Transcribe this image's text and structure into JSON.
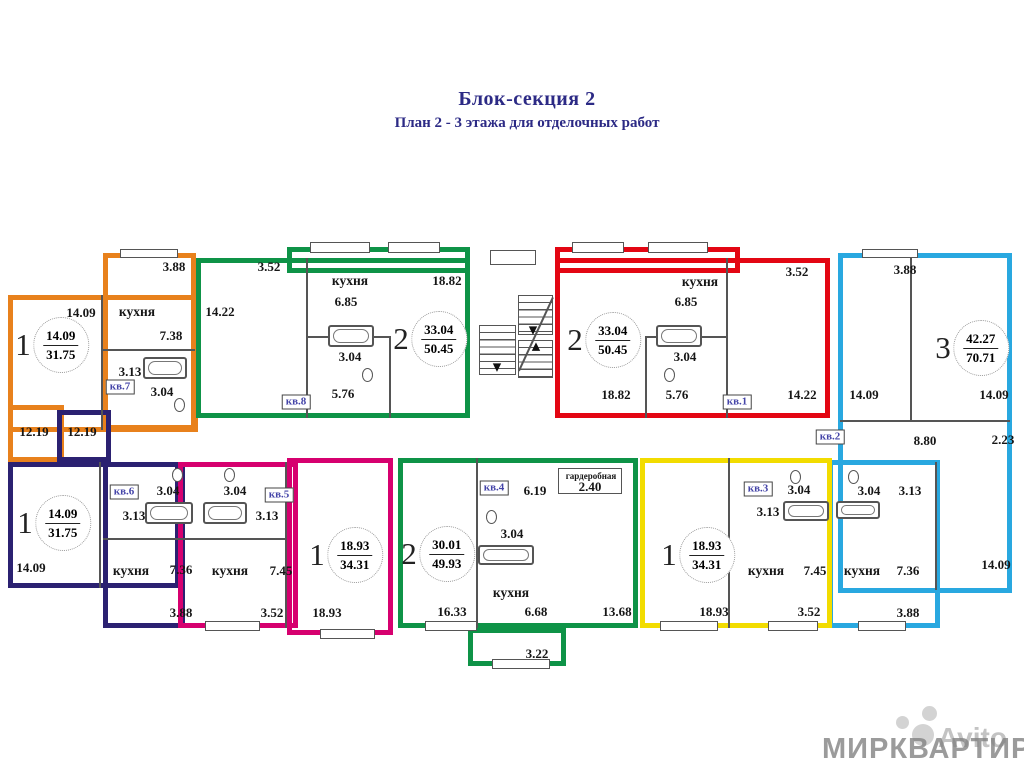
{
  "title": "Блок-секция 2",
  "subtitle": "План 2 - 3 этажа для отделочных работ",
  "watermarks": {
    "primary": "МИРКВАРТИР",
    "secondary": "Avito"
  },
  "colors": {
    "orange": "#E8811C",
    "green": "#0E9347",
    "red": "#E30613",
    "cyan": "#29A8E0",
    "navy": "#2B2171",
    "magenta": "#D6006F",
    "yellow": "#F2DC00",
    "title_text": "#2C2A85",
    "unit_tag_text": "#4444A8",
    "wall": "#555555"
  },
  "apartments": [
    {
      "unit": "кв.7",
      "rooms": "1",
      "living_area": "14.09",
      "total_area": "31.75",
      "color_key": "orange",
      "badge": {
        "x": 52,
        "y": 345
      },
      "tag": {
        "x": 120,
        "y": 387
      }
    },
    {
      "unit": "кв.8",
      "rooms": "2",
      "living_area": "33.04",
      "total_area": "50.45",
      "color_key": "green",
      "badge": {
        "x": 430,
        "y": 339
      },
      "tag": {
        "x": 296,
        "y": 402
      }
    },
    {
      "unit": "кв.1",
      "rooms": "2",
      "living_area": "33.04",
      "total_area": "50.45",
      "color_key": "red",
      "badge": {
        "x": 604,
        "y": 340
      },
      "tag": {
        "x": 737,
        "y": 402
      }
    },
    {
      "unit": "кв.2",
      "rooms": "3",
      "living_area": "42.27",
      "total_area": "70.71",
      "color_key": "cyan",
      "badge": {
        "x": 972,
        "y": 348
      },
      "tag": {
        "x": 830,
        "y": 437
      }
    },
    {
      "unit": "кв.6",
      "rooms": "1",
      "living_area": "14.09",
      "total_area": "31.75",
      "color_key": "navy",
      "badge": {
        "x": 54,
        "y": 523
      },
      "tag": {
        "x": 124,
        "y": 492
      }
    },
    {
      "unit": "кв.5",
      "rooms": "1",
      "living_area": "18.93",
      "total_area": "34.31",
      "color_key": "magenta",
      "badge": {
        "x": 346,
        "y": 555
      },
      "tag": {
        "x": 279,
        "y": 495
      }
    },
    {
      "unit": "кв.4",
      "rooms": "2",
      "living_area": "30.01",
      "total_area": "49.93",
      "color_key": "green",
      "badge": {
        "x": 438,
        "y": 554
      },
      "tag": {
        "x": 494,
        "y": 488
      }
    },
    {
      "unit": "кв.3",
      "rooms": "1",
      "living_area": "18.93",
      "total_area": "34.31",
      "color_key": "yellow",
      "badge": {
        "x": 698,
        "y": 555
      },
      "tag": {
        "x": 758,
        "y": 489
      }
    }
  ],
  "plan_labels": [
    {
      "text": "3.88",
      "x": 174,
      "y": 267
    },
    {
      "text": "14.09",
      "x": 81,
      "y": 313
    },
    {
      "text": "кухня",
      "x": 137,
      "y": 312,
      "kind": "room"
    },
    {
      "text": "7.38",
      "x": 171,
      "y": 336
    },
    {
      "text": "3.13",
      "x": 130,
      "y": 372
    },
    {
      "text": "3.04",
      "x": 162,
      "y": 392
    },
    {
      "text": "12.19",
      "x": 34,
      "y": 432
    },
    {
      "text": "12.19",
      "x": 82,
      "y": 432
    },
    {
      "text": "3.52",
      "x": 269,
      "y": 267
    },
    {
      "text": "14.22",
      "x": 220,
      "y": 312
    },
    {
      "text": "кухня",
      "x": 350,
      "y": 281,
      "kind": "room"
    },
    {
      "text": "6.85",
      "x": 346,
      "y": 302
    },
    {
      "text": "18.82",
      "x": 447,
      "y": 281
    },
    {
      "text": "3.04",
      "x": 350,
      "y": 357
    },
    {
      "text": "5.76",
      "x": 343,
      "y": 394
    },
    {
      "text": "3.52",
      "x": 797,
      "y": 272
    },
    {
      "text": "кухня",
      "x": 700,
      "y": 282,
      "kind": "room"
    },
    {
      "text": "6.85",
      "x": 686,
      "y": 302
    },
    {
      "text": "3.04",
      "x": 685,
      "y": 357
    },
    {
      "text": "18.82",
      "x": 616,
      "y": 395
    },
    {
      "text": "5.76",
      "x": 677,
      "y": 395
    },
    {
      "text": "14.22",
      "x": 802,
      "y": 395
    },
    {
      "text": "3.88",
      "x": 905,
      "y": 270
    },
    {
      "text": "14.09",
      "x": 864,
      "y": 395
    },
    {
      "text": "14.09",
      "x": 994,
      "y": 395
    },
    {
      "text": "8.80",
      "x": 925,
      "y": 441
    },
    {
      "text": "2.23",
      "x": 1003,
      "y": 440
    },
    {
      "text": "3.04",
      "x": 869,
      "y": 491
    },
    {
      "text": "3.13",
      "x": 910,
      "y": 491
    },
    {
      "text": "кухня",
      "x": 862,
      "y": 571,
      "kind": "room"
    },
    {
      "text": "7.36",
      "x": 908,
      "y": 571
    },
    {
      "text": "14.09",
      "x": 996,
      "y": 565
    },
    {
      "text": "3.88",
      "x": 908,
      "y": 613
    },
    {
      "text": "3.04",
      "x": 168,
      "y": 491
    },
    {
      "text": "3.13",
      "x": 134,
      "y": 516
    },
    {
      "text": "14.09",
      "x": 31,
      "y": 568
    },
    {
      "text": "кухня",
      "x": 131,
      "y": 571,
      "kind": "room"
    },
    {
      "text": "7.36",
      "x": 181,
      "y": 570
    },
    {
      "text": "3.88",
      "x": 181,
      "y": 613
    },
    {
      "text": "3.04",
      "x": 235,
      "y": 491
    },
    {
      "text": "3.13",
      "x": 267,
      "y": 516
    },
    {
      "text": "кухня",
      "x": 230,
      "y": 571,
      "kind": "room"
    },
    {
      "text": "7.45",
      "x": 281,
      "y": 571
    },
    {
      "text": "3.52",
      "x": 272,
      "y": 613
    },
    {
      "text": "18.93",
      "x": 327,
      "y": 613
    },
    {
      "text": "6.19",
      "x": 535,
      "y": 491
    },
    {
      "text": "гардеробная",
      "x": 591,
      "y": 476,
      "kind": "small"
    },
    {
      "text": "2.40",
      "x": 590,
      "y": 487
    },
    {
      "text": "3.04",
      "x": 512,
      "y": 534
    },
    {
      "text": "кухня",
      "x": 511,
      "y": 593,
      "kind": "room"
    },
    {
      "text": "16.33",
      "x": 452,
      "y": 612
    },
    {
      "text": "6.68",
      "x": 536,
      "y": 612
    },
    {
      "text": "13.68",
      "x": 617,
      "y": 612
    },
    {
      "text": "3.22",
      "x": 537,
      "y": 654
    },
    {
      "text": "3.04",
      "x": 799,
      "y": 490
    },
    {
      "text": "3.13",
      "x": 768,
      "y": 512
    },
    {
      "text": "кухня",
      "x": 766,
      "y": 571,
      "kind": "room"
    },
    {
      "text": "7.45",
      "x": 815,
      "y": 571
    },
    {
      "text": "18.93",
      "x": 714,
      "y": 612
    },
    {
      "text": "3.52",
      "x": 809,
      "y": 612
    }
  ]
}
